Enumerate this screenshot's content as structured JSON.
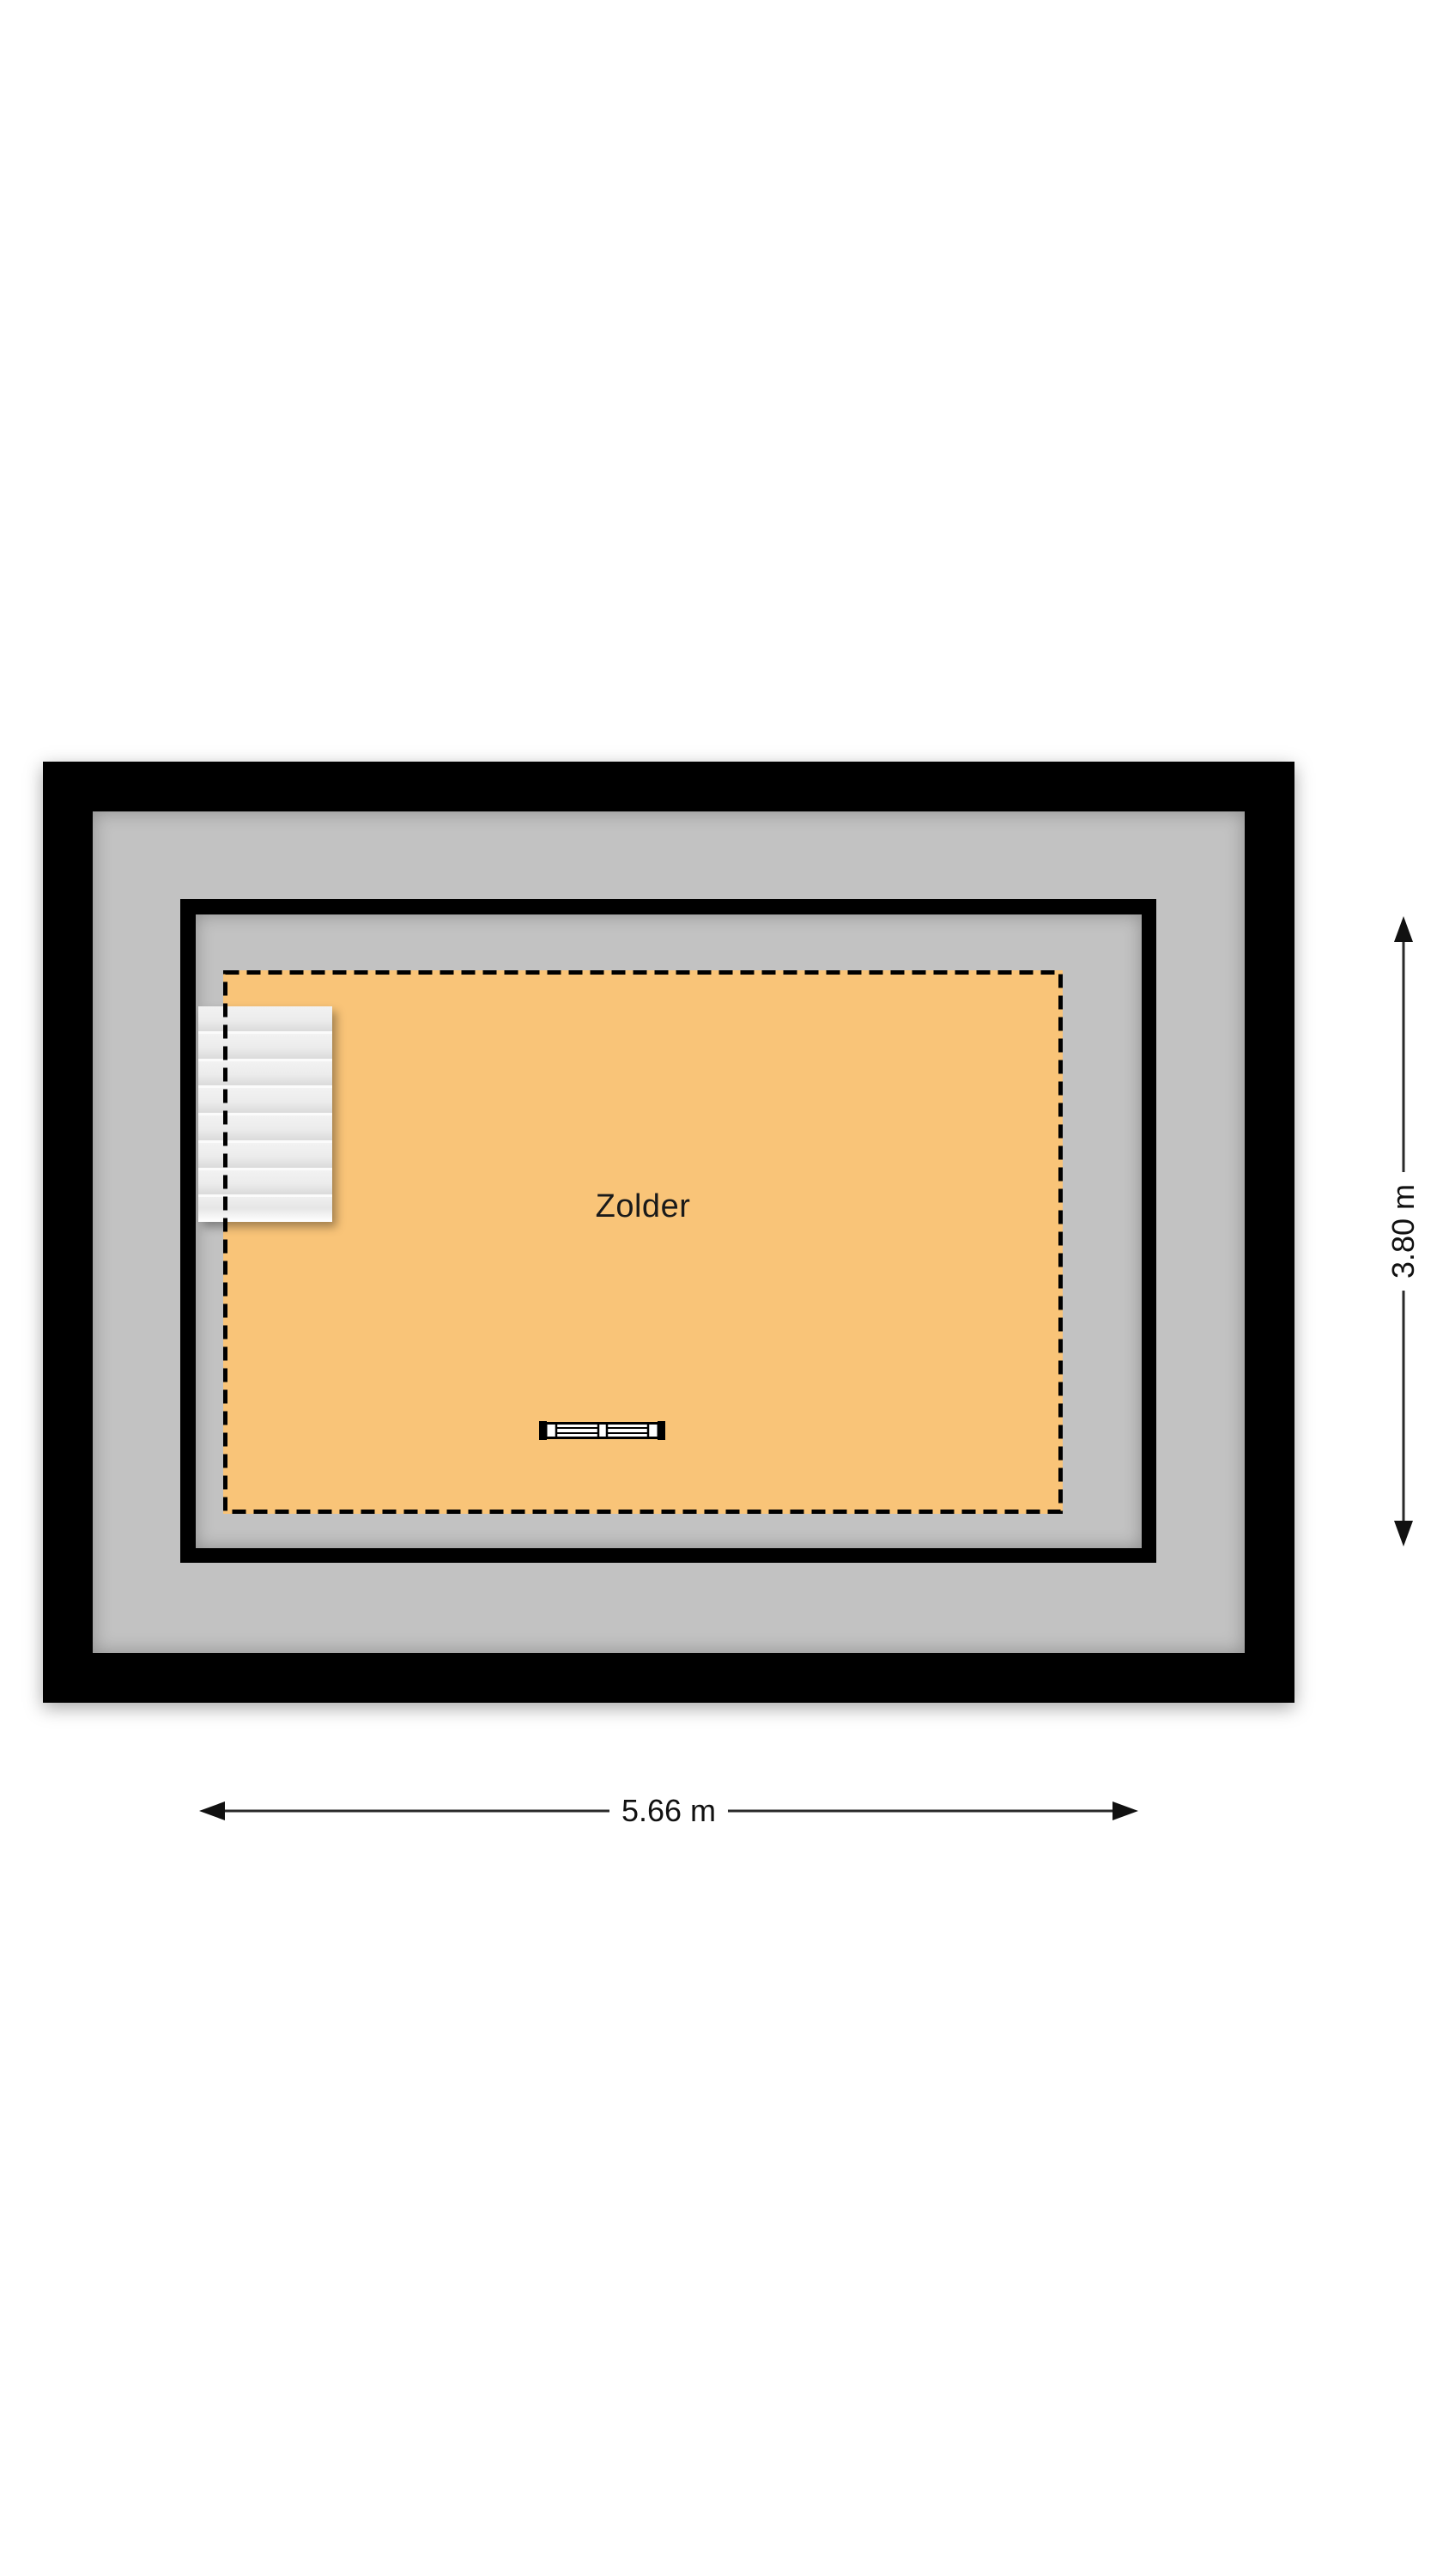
{
  "floorplan": {
    "room": {
      "label": "Zolder",
      "fill_color": "#F9C478"
    },
    "colors": {
      "wall": "#000000",
      "floor_gray": "#C2C2C2",
      "stairs": "#ECECEC",
      "background": "#FFFFFF"
    },
    "fixtures": {
      "stairs": "stairs-top-left",
      "radiator": "radiator-bottom-center"
    },
    "dimensions": {
      "width": {
        "label": "5.66 m"
      },
      "height": {
        "label": "3.80 m"
      }
    }
  }
}
